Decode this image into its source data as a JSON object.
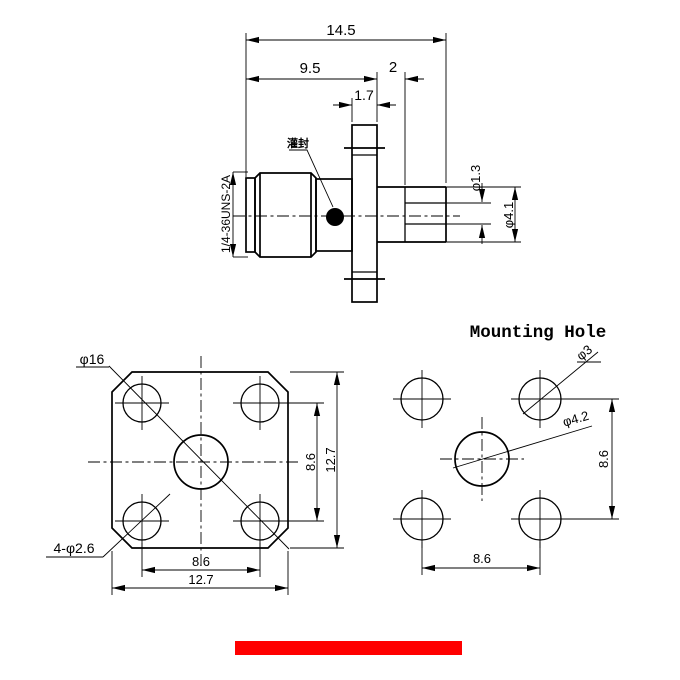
{
  "side_view": {
    "dim_overall": "14.5",
    "dim_to_flange": "9.5",
    "dim_shoulder": "2",
    "dim_flange_thickness": "1.7",
    "dim_pin_diameter": "φ1.3",
    "dim_body_diameter": "φ4.1",
    "thread_spec": "1/4-36UNS-2A",
    "potting_label": "灌封"
  },
  "flange_view": {
    "dim_outer_diagonal": "φ16",
    "dim_corner_holes": "4-φ2.6",
    "dim_hole_pitch_vertical": "8.6",
    "dim_flange_height": "12.7",
    "dim_hole_pitch_horizontal": "8.6",
    "dim_flange_width": "12.7"
  },
  "mounting_view": {
    "title": "Mounting Hole",
    "dim_hole_diameter": "φ3",
    "dim_center_hole_diameter": "φ4.2",
    "dim_pitch_vertical": "8.6",
    "dim_pitch_horizontal": "8.6"
  },
  "colors": {
    "line": "#000000",
    "accent_bar": "#ff0000"
  }
}
